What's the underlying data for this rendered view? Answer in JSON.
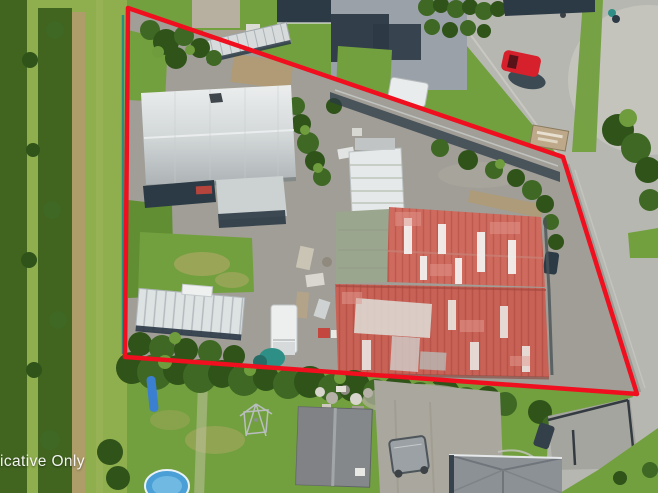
{
  "watermark": {
    "text": "icative Only"
  },
  "boundary": {
    "points": "128,8 563,157 637,394 125,357",
    "fence_points": "123,15 123,354",
    "line_color": "#ef0f1e",
    "fence_color": "#1f8a85"
  },
  "colors": {
    "red-line": "#ef0f1e",
    "teal-fence": "#1f8a85",
    "lawn": "#72a03e",
    "lawn-dark": "#618d33",
    "orchard": "#8fae4e",
    "orchard-dark": "#41641f",
    "dirt": "#b49a6e",
    "dry-grass": "#b5a96b",
    "concrete": "#a09e96",
    "road": "#b7b7b1",
    "road-light": "#c5c5bf",
    "roof-navy": "#2c3a45",
    "roof-gray": "#9aa1a8",
    "roof-red": "#cf6a5e",
    "roof-red2": "#c96256",
    "tree": "#3e6824",
    "tree-dark": "#2f5319",
    "tree-light": "#6f9c3c",
    "pool": "#4aa0d6",
    "car-red": "#d6202b",
    "teal": "#2e8f86",
    "shed-gray": "#85888b"
  }
}
